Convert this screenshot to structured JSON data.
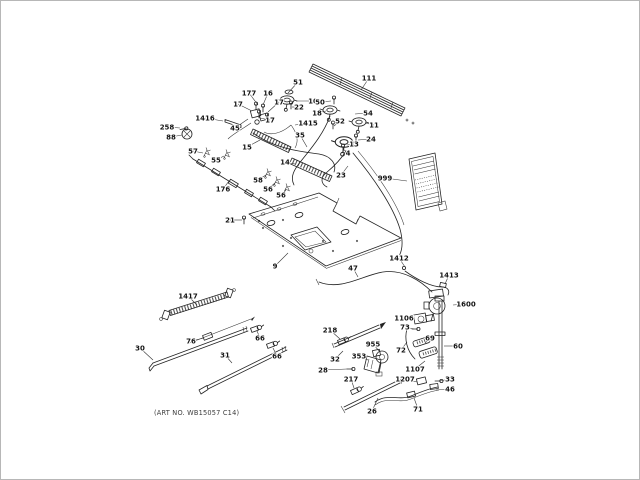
{
  "figure": {
    "title": "exploded-parts-diagram",
    "footer_note": "(ART NO. WB15057 C14)"
  },
  "placard": {
    "id": "999",
    "description": "mini-label-card"
  },
  "labels": [
    {
      "t": "51",
      "x": 297,
      "y": 81,
      "tx": 287,
      "ty": 92
    },
    {
      "t": "10",
      "x": 312,
      "y": 100,
      "tx": 295,
      "ty": 100
    },
    {
      "t": "177",
      "x": 248,
      "y": 92,
      "tx": 257,
      "ty": 104
    },
    {
      "t": "16",
      "x": 267,
      "y": 92,
      "tx": 262,
      "ty": 104
    },
    {
      "t": "17",
      "x": 237,
      "y": 103,
      "tx": 251,
      "ty": 110
    },
    {
      "t": "17",
      "x": 278,
      "y": 101,
      "tx": 267,
      "ty": 111
    },
    {
      "t": "17",
      "x": 269,
      "y": 119,
      "tx": 259,
      "ty": 117
    },
    {
      "t": "22",
      "x": 298,
      "y": 106,
      "tx": 291,
      "ty": 106
    },
    {
      "t": "1416",
      "x": 204,
      "y": 117,
      "tx": 222,
      "ty": 120
    },
    {
      "t": "45",
      "x": 234,
      "y": 127,
      "tx": 247,
      "ty": 118
    },
    {
      "t": "15",
      "x": 246,
      "y": 146,
      "tx": 259,
      "ty": 139
    },
    {
      "t": "1415",
      "x": 307,
      "y": 122,
      "tx": 294,
      "ty": 124
    },
    {
      "t": "35",
      "x": 299,
      "y": 134,
      "tx": 306,
      "ty": 146
    },
    {
      "t": "111",
      "x": 368,
      "y": 77,
      "tx": 360,
      "ty": 89
    },
    {
      "t": "50",
      "x": 319,
      "y": 101,
      "tx": 330,
      "ty": 100
    },
    {
      "t": "18",
      "x": 316,
      "y": 112,
      "tx": 325,
      "ty": 110
    },
    {
      "t": "52",
      "x": 339,
      "y": 120,
      "tx": 333,
      "ty": 125
    },
    {
      "t": "54",
      "x": 367,
      "y": 112,
      "tx": 354,
      "ty": 113
    },
    {
      "t": "11",
      "x": 373,
      "y": 124,
      "tx": 364,
      "ty": 122
    },
    {
      "t": "24",
      "x": 370,
      "y": 138,
      "tx": 357,
      "ty": 139
    },
    {
      "t": "13",
      "x": 353,
      "y": 143,
      "tx": 346,
      "ty": 144
    },
    {
      "t": "4",
      "x": 347,
      "y": 152,
      "tx": 342,
      "ty": 148
    },
    {
      "t": "23",
      "x": 340,
      "y": 174,
      "tx": 347,
      "ty": 165
    },
    {
      "t": "999",
      "x": 384,
      "y": 177,
      "tx": 406,
      "ty": 180
    },
    {
      "t": "258",
      "x": 166,
      "y": 126,
      "tx": 179,
      "ty": 127
    },
    {
      "t": "88",
      "x": 170,
      "y": 136,
      "tx": 181,
      "ty": 134
    },
    {
      "t": "57",
      "x": 192,
      "y": 150,
      "tx": 202,
      "ty": 152
    },
    {
      "t": "55",
      "x": 215,
      "y": 159,
      "tx": 223,
      "ty": 155
    },
    {
      "t": "176",
      "x": 222,
      "y": 188,
      "tx": 228,
      "ty": 180
    },
    {
      "t": "58",
      "x": 257,
      "y": 179,
      "tx": 265,
      "ty": 174
    },
    {
      "t": "56",
      "x": 267,
      "y": 188,
      "tx": 274,
      "ty": 182
    },
    {
      "t": "56",
      "x": 280,
      "y": 194,
      "tx": 285,
      "ty": 189
    },
    {
      "t": "14",
      "x": 284,
      "y": 161,
      "tx": 294,
      "ty": 163
    },
    {
      "t": "21",
      "x": 229,
      "y": 219,
      "tx": 241,
      "ty": 219
    },
    {
      "t": "9",
      "x": 274,
      "y": 265,
      "tx": 287,
      "ty": 252
    },
    {
      "t": "47",
      "x": 352,
      "y": 267,
      "tx": 357,
      "ty": 276
    },
    {
      "t": "1412",
      "x": 398,
      "y": 257,
      "tx": 404,
      "ty": 266
    },
    {
      "t": "1413",
      "x": 448,
      "y": 274,
      "tx": 444,
      "ty": 283
    },
    {
      "t": "1600",
      "x": 465,
      "y": 303,
      "tx": 452,
      "ty": 304
    },
    {
      "t": "1106",
      "x": 403,
      "y": 317,
      "tx": 414,
      "ty": 318
    },
    {
      "t": "73",
      "x": 404,
      "y": 326,
      "tx": 413,
      "ty": 328
    },
    {
      "t": "69",
      "x": 429,
      "y": 337,
      "tx": 424,
      "ty": 342
    },
    {
      "t": "60",
      "x": 457,
      "y": 345,
      "tx": 443,
      "ty": 345
    },
    {
      "t": "72",
      "x": 400,
      "y": 349,
      "tx": 406,
      "ty": 341
    },
    {
      "t": "955",
      "x": 372,
      "y": 343,
      "tx": 379,
      "ty": 351
    },
    {
      "t": "353",
      "x": 358,
      "y": 355,
      "tx": 367,
      "ty": 359
    },
    {
      "t": "218",
      "x": 329,
      "y": 329,
      "tx": 339,
      "ty": 338
    },
    {
      "t": "32",
      "x": 334,
      "y": 358,
      "tx": 342,
      "ty": 350
    },
    {
      "t": "28",
      "x": 322,
      "y": 369,
      "tx": 346,
      "ty": 368
    },
    {
      "t": "217",
      "x": 350,
      "y": 378,
      "tx": 353,
      "ty": 387
    },
    {
      "t": "26",
      "x": 371,
      "y": 410,
      "tx": 377,
      "ty": 397
    },
    {
      "t": "1107",
      "x": 414,
      "y": 368,
      "tx": 424,
      "ty": 360
    },
    {
      "t": "1207",
      "x": 404,
      "y": 378,
      "tx": 416,
      "ty": 381
    },
    {
      "t": "33",
      "x": 449,
      "y": 378,
      "tx": 438,
      "ty": 380
    },
    {
      "t": "46",
      "x": 449,
      "y": 388,
      "tx": 435,
      "ty": 389
    },
    {
      "t": "71",
      "x": 417,
      "y": 408,
      "tx": 413,
      "ty": 397
    },
    {
      "t": "1417",
      "x": 187,
      "y": 295,
      "tx": 196,
      "ty": 304
    },
    {
      "t": "76",
      "x": 190,
      "y": 340,
      "tx": 203,
      "ty": 337
    },
    {
      "t": "30",
      "x": 139,
      "y": 347,
      "tx": 152,
      "ty": 359
    },
    {
      "t": "31",
      "x": 224,
      "y": 354,
      "tx": 231,
      "ty": 362
    },
    {
      "t": "66",
      "x": 259,
      "y": 337,
      "tx": 256,
      "ty": 330
    },
    {
      "t": "66",
      "x": 276,
      "y": 355,
      "tx": 272,
      "ty": 347
    }
  ]
}
